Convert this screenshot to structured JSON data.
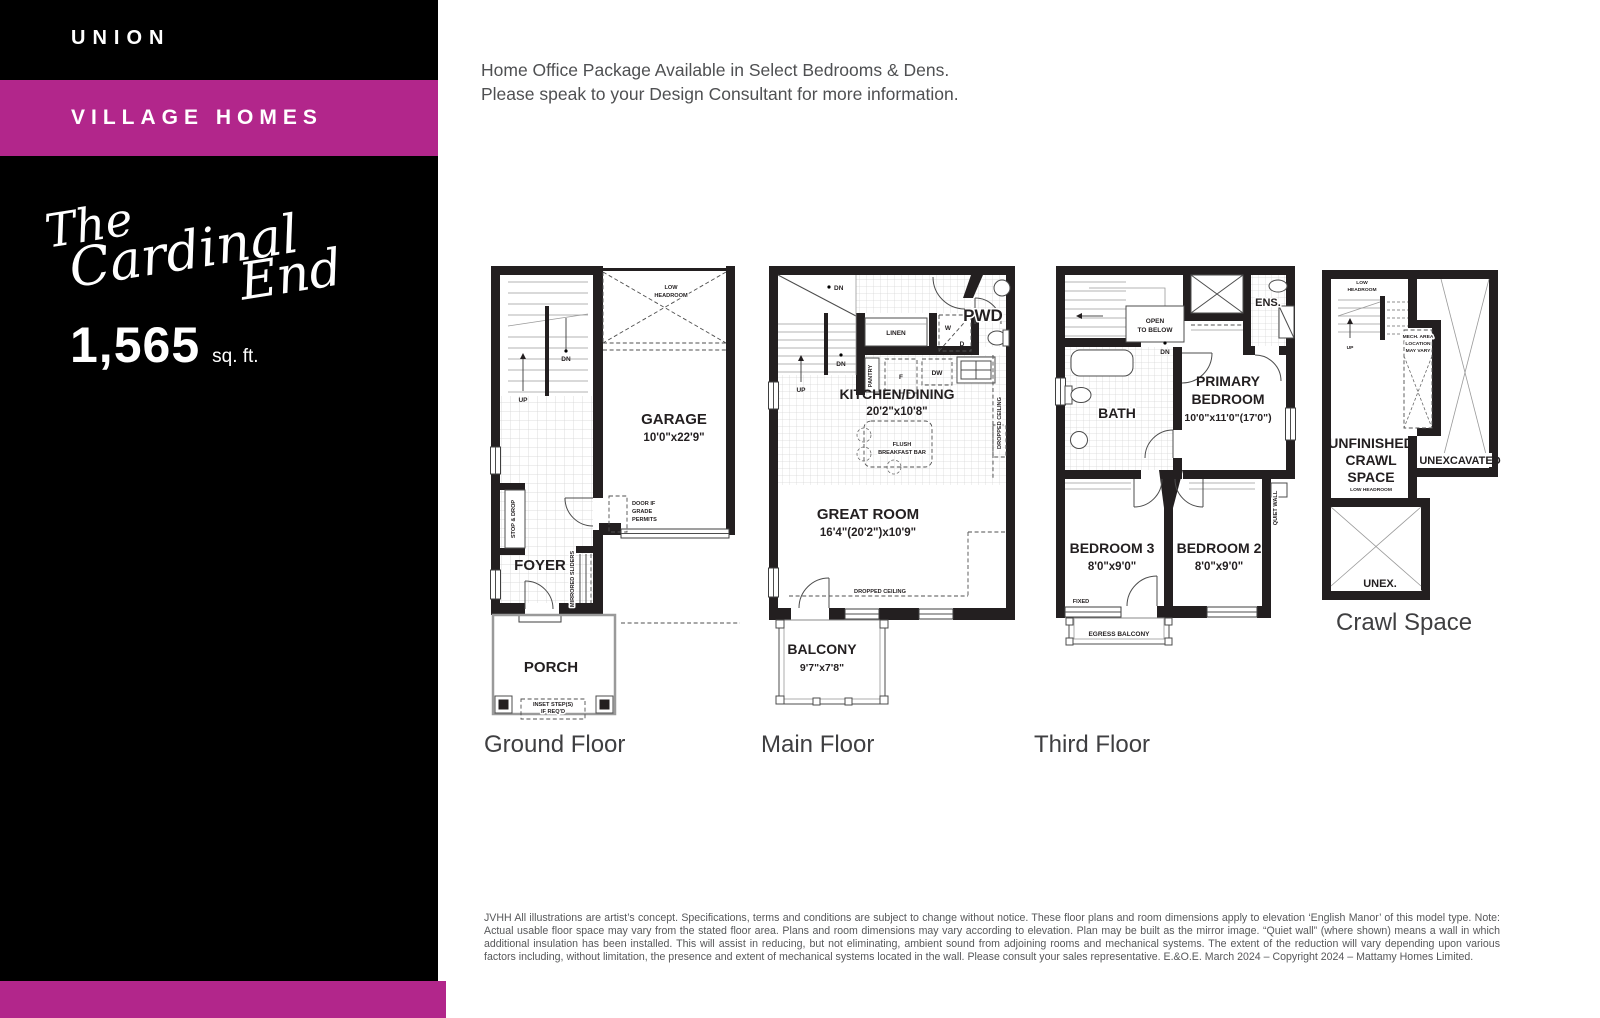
{
  "sidebar": {
    "brand": "UNION",
    "series": "VILLAGE HOMES",
    "model_script": {
      "line1": "The",
      "line2": "Cardinal",
      "line3": "End"
    },
    "area": {
      "value": "1,565",
      "unit": "sq. ft."
    }
  },
  "header": {
    "line1": "Home Office Package Available in Select Bedrooms & Dens.",
    "line2": "Please speak to your Design Consultant for more information."
  },
  "floors": {
    "ground": {
      "name": "Ground Floor",
      "labels": {
        "low1": "LOW",
        "low2": "HEADROOM",
        "dn": "DN",
        "up": "UP",
        "garage": "GARAGE",
        "garage_dim": "10'0\"x22'9\"",
        "stop_drop": "STOP & DROP",
        "door1": "DOOR IF",
        "door2": "GRADE",
        "door3": "PERMITS",
        "foyer": "FOYER",
        "sliders": "MIRRORED SLIDERS",
        "porch": "PORCH",
        "inset1": "INSET STEP(S)",
        "inset2": "IF REQ'D"
      }
    },
    "main": {
      "name": "Main Floor",
      "labels": {
        "dn1": "DN",
        "dn2": "DN",
        "up": "UP",
        "linen": "LINEN",
        "w": "W",
        "d": "D",
        "pwd": "PWD",
        "pantry": "PANTRY",
        "f": "F",
        "dw": "DW",
        "s": "S",
        "kitchen": "KITCHEN/DINING",
        "kitchen_dim": "20'2\"x10'8\"",
        "flush1": "FLUSH",
        "flush2": "BREAKFAST BAR",
        "dropped_v": "DROPPED CEILING",
        "dropped_h": "DROPPED CEILING",
        "great": "GREAT ROOM",
        "great_dim": "16'4\"(20'2\")x10'9\"",
        "balcony": "BALCONY",
        "balcony_dim": "9'7\"x7'8\""
      }
    },
    "third": {
      "name": "Third Floor",
      "labels": {
        "open1": "OPEN",
        "open2": "TO BELOW",
        "dn": "DN",
        "ens": "ENS.",
        "bath": "BATH",
        "primary1": "PRIMARY",
        "primary2": "BEDROOM",
        "primary_dim": "10'0\"x11'0\"(17'0\")",
        "bed3": "BEDROOM 3",
        "bed3_dim": "8'0\"x9'0\"",
        "bed2": "BEDROOM 2",
        "bed2_dim": "8'0\"x9'0\"",
        "fixed": "FIXED",
        "egress": "EGRESS BALCONY",
        "quiet": "QUIET WALL"
      }
    },
    "crawl": {
      "name": "Crawl Space",
      "labels": {
        "low1": "LOW",
        "low2": "HEADROOM",
        "up": "UP",
        "mech1": "MECH. AREA",
        "mech2": "LOCATION",
        "mech3": "MAY VARY",
        "unf1": "UNFINISHED",
        "unf2": "CRAWL",
        "unf3": "SPACE",
        "low_sub": "LOW HEADROOM",
        "unexcavated": "UNEXCAVATED",
        "unex": "UNEX."
      }
    }
  },
  "footer": {
    "disclaimer": "JVHH All illustrations are artist’s concept. Specifications, terms and conditions are subject to change without notice. These floor plans and room dimensions apply to elevation ‘English Manor’ of this model type. Note: Actual usable floor space may vary from the stated floor area. Plans and room dimensions may vary according to elevation. Plan may be built as the mirror image. “Quiet wall” (where shown) means a wall in which additional insulation has been installed. This will assist in reducing, but not eliminating, ambient sound from adjoining rooms and mechanical systems. The extent of the reduction will vary depending upon various factors including, without limitation, the presence and extent of mechanical systems located in the wall. Please consult your sales representative. E.&O.E. March 2024 – Copyright 2024 – Mattamy Homes Limited."
  },
  "colors": {
    "accent_magenta": "#B2268B",
    "sidebar_black": "#000000",
    "wall": "#231f20",
    "text_gray": "#57585a"
  }
}
